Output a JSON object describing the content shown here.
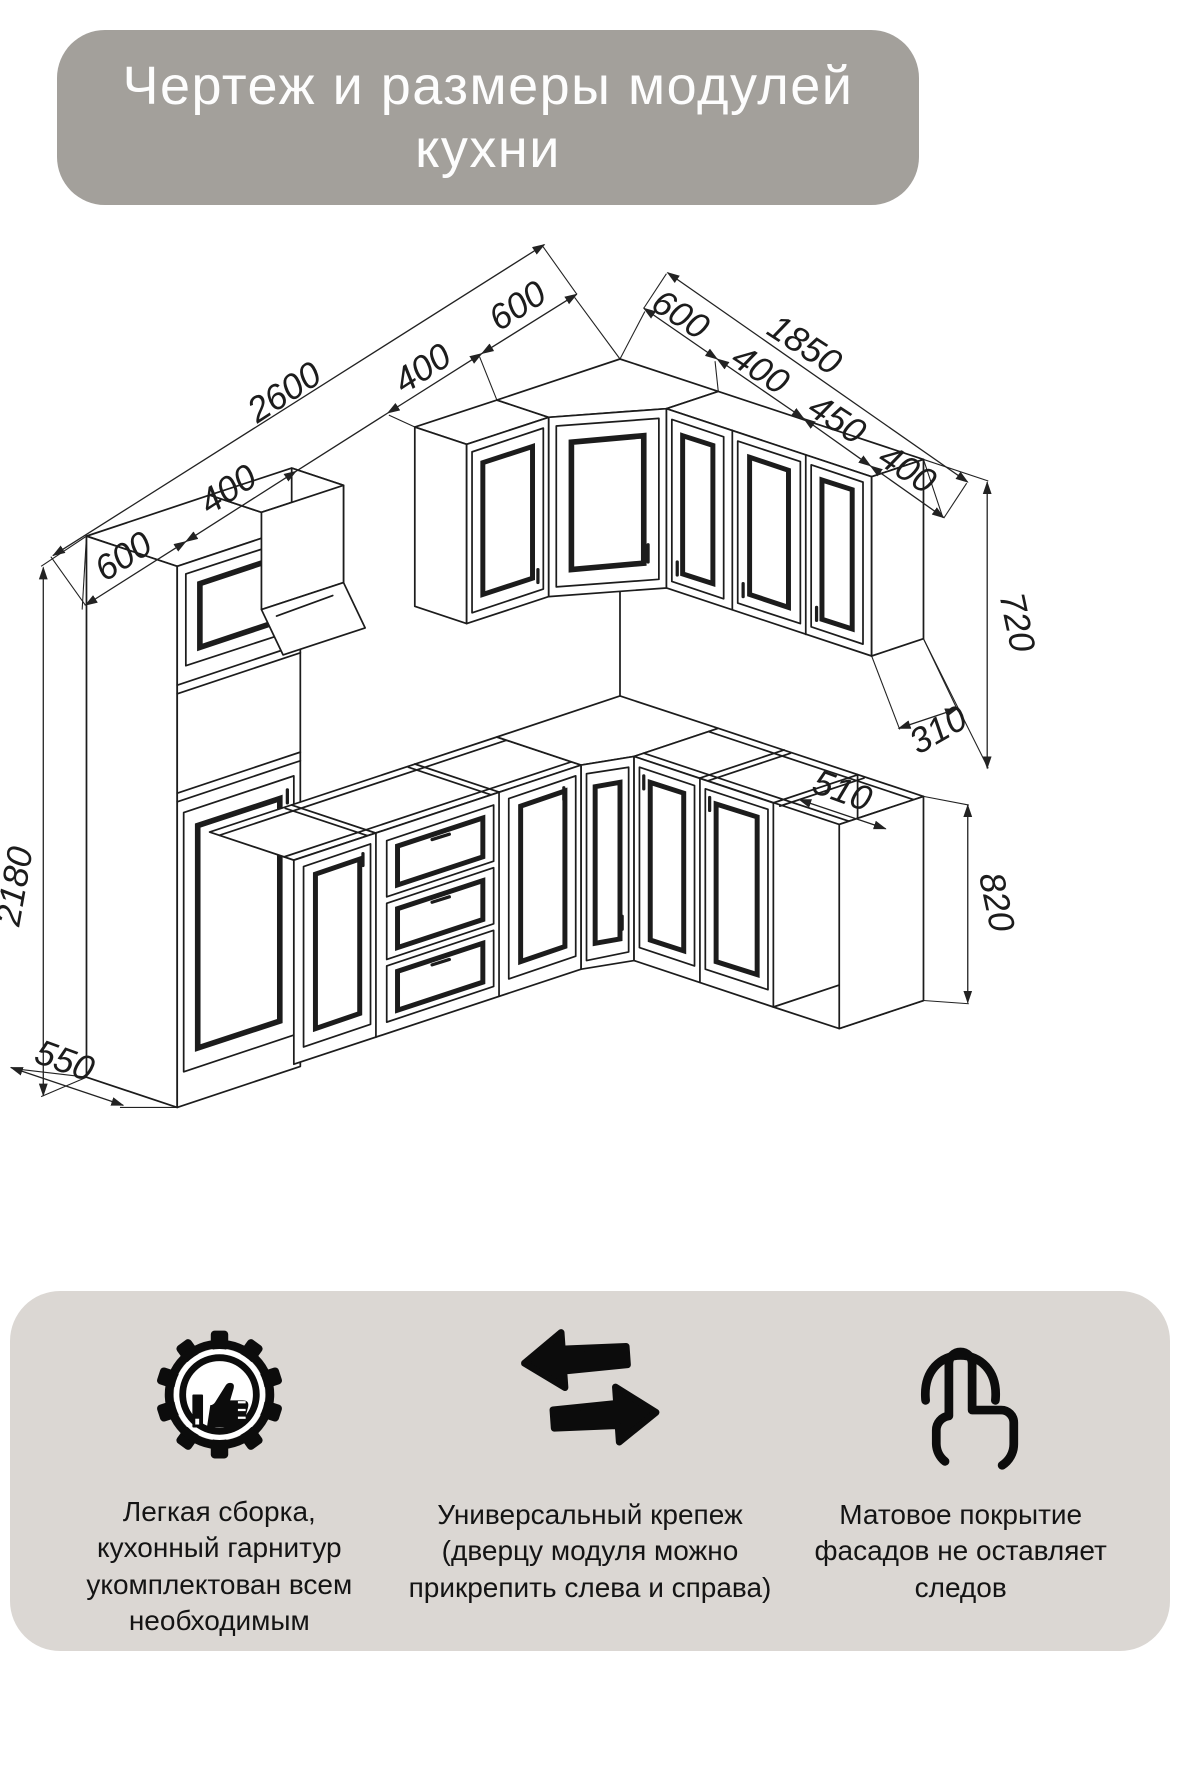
{
  "title": {
    "text": "Чертеж и размеры модулей\nкухни",
    "bg_color": "#a3a09b",
    "text_color": "#fdfdfd"
  },
  "drawing": {
    "description": "Isometric CAD line drawing of an L-shaped kitchen with dimension chains (mm)",
    "dimensions": {
      "left_wall": {
        "total": "2600",
        "segments": [
          "600",
          "400",
          "400",
          "600"
        ]
      },
      "right_wall": {
        "total": "1850",
        "corner_segment": "600",
        "segments": [
          "400",
          "450",
          "400"
        ]
      },
      "wall_cabinet_height": "720",
      "wall_cabinet_depth": "310",
      "tall_cabinet_height": "2180",
      "tall_cabinet_depth": "550",
      "base_cabinet_depth": "510",
      "base_cabinet_height": "820"
    }
  },
  "features_panel": {
    "bg_color": "#dbd7d3",
    "features": [
      {
        "icon": "gear-thumbs-up-icon",
        "text": "Легкая сборка,\nкухонный гарнитур\nукомплектован всем\nнеобходимым"
      },
      {
        "icon": "swap-arrows-icon",
        "text": "Универсальный крепеж\n(дверцу модуля можно\nприкрепить слева и справа)"
      },
      {
        "icon": "touch-finger-icon",
        "text": "Матовое покрытие\nфасадов не оставляет\nследов"
      }
    ]
  }
}
